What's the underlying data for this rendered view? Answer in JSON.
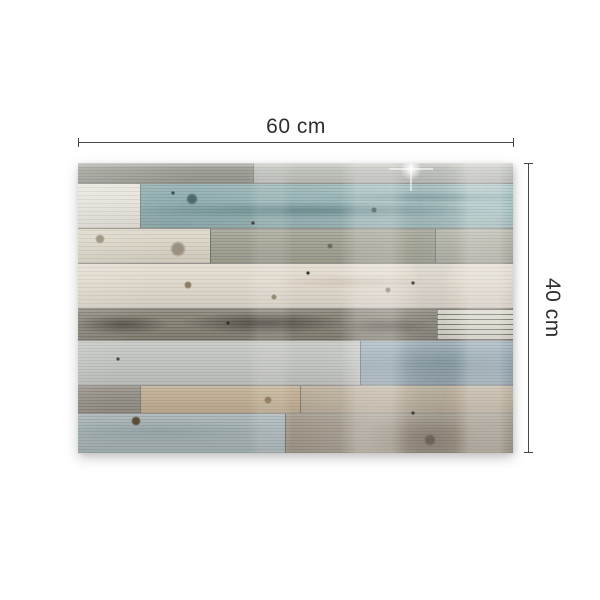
{
  "dimensions": {
    "width_label": "60 cm",
    "height_label": "40 cm",
    "line_color": "#474747",
    "text_color": "#2e2e2e"
  },
  "panel": {
    "width": 435,
    "height": 290,
    "rows": [
      {
        "h": 20,
        "segments": [
          {
            "w": 175,
            "base": "#a2a49b",
            "streak": "rgba(60,62,52,0.16)",
            "gap": 3
          },
          {
            "w": 260,
            "base": "#c4c6c1",
            "streak": "rgba(90,92,86,0.12)",
            "gap": 3
          }
        ]
      },
      {
        "h": 45,
        "segments": [
          {
            "w": 62,
            "base": "#e6e4db",
            "streak": "rgba(120,110,95,0.14)",
            "gap": 4
          },
          {
            "w": 373,
            "base": "#9cb9ba",
            "streak": "rgba(60,95,100,0.18)",
            "gap": 3,
            "tint": [
              "rgba(0,0,0,0.05)",
              "rgba(255,255,255,0.18)"
            ],
            "blotches": [
              {
                "x": "45%",
                "y": "60%",
                "w": 280,
                "h": 12,
                "color": "rgba(47,88,93,0.40)"
              },
              {
                "x": "78%",
                "y": "30%",
                "w": 160,
                "h": 8,
                "color": "rgba(47,88,93,0.28)"
              }
            ]
          }
        ]
      },
      {
        "h": 35,
        "segments": [
          {
            "w": 132,
            "base": "#dcd7c9",
            "streak": "rgba(130,120,100,0.16)",
            "gap": 4
          },
          {
            "w": 225,
            "base": "#a7a799",
            "streak": "rgba(70,70,58,0.18)",
            "gap": 3
          },
          {
            "w": 78,
            "base": "#b5b5a9",
            "streak": "rgba(70,70,58,0.14)",
            "gap": 3
          }
        ]
      },
      {
        "h": 45,
        "segments": [
          {
            "w": 435,
            "base": "#e2dbd0",
            "streak": "rgba(150,130,110,0.15)",
            "gap": 4,
            "blotches": [
              {
                "x": "64%",
                "y": "40%",
                "w": 120,
                "h": 10,
                "color": "rgba(150,120,95,0.18)"
              }
            ]
          }
        ]
      },
      {
        "h": 32,
        "segments": [
          {
            "w": 359,
            "base": "#8f8a7e",
            "streak": "rgba(45,42,36,0.22)",
            "gap": 3,
            "blotches": [
              {
                "x": "12%",
                "y": "50%",
                "w": 70,
                "h": 14,
                "color": "rgba(44,41,35,0.50)"
              },
              {
                "x": "52%",
                "y": "45%",
                "w": 120,
                "h": 16,
                "color": "rgba(40,38,32,0.55)"
              },
              {
                "x": "86%",
                "y": "55%",
                "w": 70,
                "h": 12,
                "color": "rgba(44,41,35,0.38)"
              }
            ]
          },
          {
            "w": 76,
            "base": "#d9d6ca",
            "streak": "rgba(42,41,37,0.55)",
            "gap": 5
          }
        ]
      },
      {
        "h": 45,
        "segments": [
          {
            "w": 282,
            "base": "#c7c9c6",
            "streak": "rgba(95,97,94,0.14)",
            "gap": 3
          },
          {
            "w": 153,
            "base": "#9fafb8",
            "streak": "rgba(70,90,102,0.20)",
            "gap": 3,
            "blotches": [
              {
                "x": "50%",
                "y": "50%",
                "w": 170,
                "h": 28,
                "color": "rgba(86,108,120,0.28)"
              }
            ]
          }
        ]
      },
      {
        "h": 28,
        "segments": [
          {
            "w": 62,
            "base": "#9b968d",
            "streak": "rgba(60,57,50,0.20)",
            "gap": 3
          },
          {
            "w": 160,
            "base": "#c3b399",
            "streak": "rgba(140,115,85,0.22)",
            "gap": 3
          },
          {
            "w": 213,
            "base": "#bdb2a0",
            "streak": "rgba(120,105,85,0.18)",
            "gap": 3
          }
        ]
      },
      {
        "h": 40,
        "segments": [
          {
            "w": 207,
            "base": "#aab5b7",
            "streak": "rgba(80,98,100,0.20)",
            "gap": 3,
            "blotches": [
              {
                "x": "40%",
                "y": "45%",
                "w": 180,
                "h": 18,
                "color": "rgba(118,136,138,0.30)"
              }
            ]
          },
          {
            "w": 228,
            "base": "#a49b8e",
            "streak": "rgba(95,85,70,0.20)",
            "gap": 3,
            "blotches": [
              {
                "x": "60%",
                "y": "60%",
                "w": 90,
                "h": 30,
                "color": "rgba(110,100,86,0.35)"
              }
            ]
          }
        ]
      }
    ],
    "knots": [
      {
        "x": 114,
        "y": 36,
        "r": 6,
        "color": "#4f6b6e"
      },
      {
        "x": 296,
        "y": 47,
        "r": 3,
        "color": "#3f5659"
      },
      {
        "x": 22,
        "y": 76,
        "r": 5,
        "color": "#96907c"
      },
      {
        "x": 100,
        "y": 86,
        "r": 8,
        "color": "#9a9181"
      },
      {
        "x": 252,
        "y": 83,
        "r": 3,
        "color": "#6d6d5f"
      },
      {
        "x": 110,
        "y": 122,
        "r": 4,
        "color": "#8d7c64"
      },
      {
        "x": 196,
        "y": 134,
        "r": 3,
        "color": "#8d7c64"
      },
      {
        "x": 310,
        "y": 127,
        "r": 3,
        "color": "#97866e"
      },
      {
        "x": 190,
        "y": 237,
        "r": 4,
        "color": "#8a6f50"
      },
      {
        "x": 58,
        "y": 258,
        "r": 5,
        "color": "#5c4b35"
      },
      {
        "x": 352,
        "y": 277,
        "r": 6,
        "color": "#6e6557"
      },
      {
        "x": 175,
        "y": 60,
        "r": 2,
        "color": "#3a3a35"
      },
      {
        "x": 230,
        "y": 110,
        "r": 2,
        "color": "#3a3a35"
      },
      {
        "x": 335,
        "y": 120,
        "r": 2,
        "color": "#3a3a35"
      },
      {
        "x": 150,
        "y": 160,
        "r": 2,
        "color": "#33312c"
      },
      {
        "x": 40,
        "y": 196,
        "r": 2,
        "color": "#4a4a46"
      },
      {
        "x": 335,
        "y": 250,
        "r": 2,
        "color": "#3a3a35"
      },
      {
        "x": 95,
        "y": 30,
        "r": 2,
        "color": "#3c4c4e"
      }
    ],
    "sheen_bands": [
      {
        "x": 170,
        "w": 45,
        "color": "rgba(255,255,255,0.10)"
      },
      {
        "x": 262,
        "w": 68,
        "color": "rgba(255,255,255,0.20)"
      },
      {
        "x": 330,
        "w": 47,
        "color": "rgba(60,75,80,0.05)"
      },
      {
        "x": 377,
        "w": 58,
        "color": "rgba(255,255,255,0.22)"
      }
    ],
    "glint": {
      "x": 311,
      "y": -16
    }
  }
}
